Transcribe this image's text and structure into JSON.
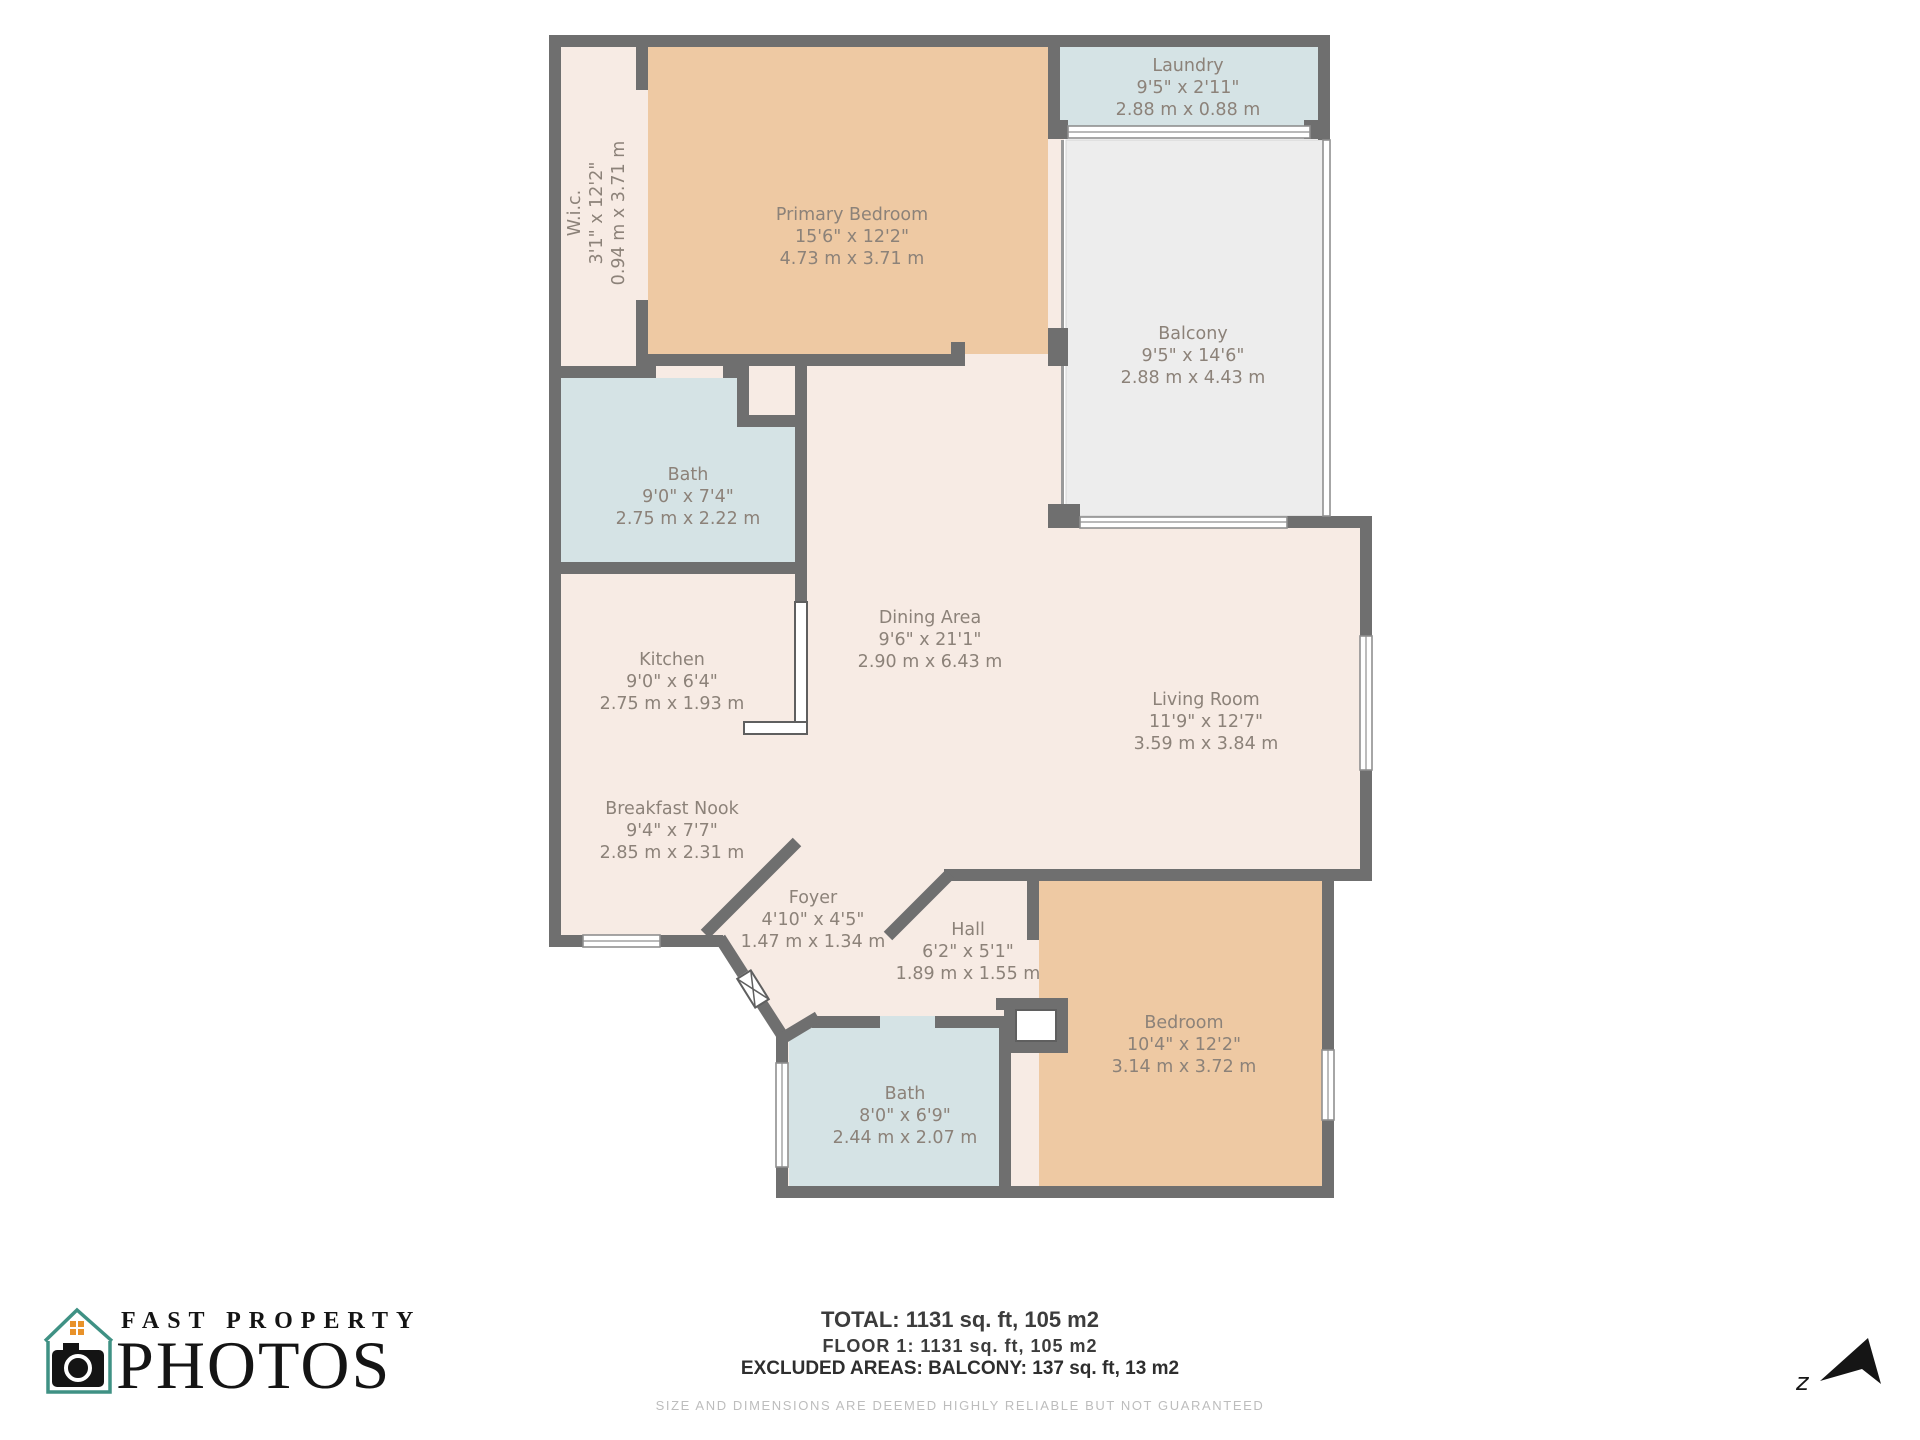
{
  "rooms": [
    {
      "id": "wic",
      "name": "W.i.c.",
      "dim_imperial": "3'1\" x 12'2\"",
      "dim_metric": "0.94 m x 3.71 m"
    },
    {
      "id": "primary_bedroom",
      "name": "Primary Bedroom",
      "dim_imperial": "15'6\" x 12'2\"",
      "dim_metric": "4.73 m x 3.71 m"
    },
    {
      "id": "laundry",
      "name": "Laundry",
      "dim_imperial": "9'5\" x 2'11\"",
      "dim_metric": "2.88 m x 0.88 m"
    },
    {
      "id": "balcony",
      "name": "Balcony",
      "dim_imperial": "9'5\" x 14'6\"",
      "dim_metric": "2.88 m x 4.43 m"
    },
    {
      "id": "bath_1",
      "name": "Bath",
      "dim_imperial": "9'0\" x 7'4\"",
      "dim_metric": "2.75 m x 2.22 m"
    },
    {
      "id": "kitchen",
      "name": "Kitchen",
      "dim_imperial": "9'0\" x 6'4\"",
      "dim_metric": "2.75 m x 1.93 m"
    },
    {
      "id": "dining_area",
      "name": "Dining Area",
      "dim_imperial": "9'6\" x 21'1\"",
      "dim_metric": "2.90 m x 6.43 m"
    },
    {
      "id": "living_room",
      "name": "Living Room",
      "dim_imperial": "11'9\" x 12'7\"",
      "dim_metric": "3.59 m x 3.84 m"
    },
    {
      "id": "breakfast_nook",
      "name": "Breakfast Nook",
      "dim_imperial": "9'4\" x 7'7\"",
      "dim_metric": "2.85 m x 2.31 m"
    },
    {
      "id": "foyer",
      "name": "Foyer",
      "dim_imperial": "4'10\" x 4'5\"",
      "dim_metric": "1.47 m x 1.34 m"
    },
    {
      "id": "hall",
      "name": "Hall",
      "dim_imperial": "6'2\" x 5'1\"",
      "dim_metric": "1.89 m x 1.55 m"
    },
    {
      "id": "bath_2",
      "name": "Bath",
      "dim_imperial": "8'0\" x 6'9\"",
      "dim_metric": "2.44 m x 2.07 m"
    },
    {
      "id": "bedroom",
      "name": "Bedroom",
      "dim_imperial": "10'4\" x 12'2\"",
      "dim_metric": "3.14 m x 3.72 m"
    }
  ],
  "summary": {
    "total": "TOTAL: 1131 sq. ft, 105 m2",
    "floor": "FLOOR 1: 1131 sq. ft, 105 m2",
    "excluded": "EXCLUDED AREAS: BALCONY: 137 sq. ft, 13 m2",
    "disclaimer": "SIZE AND DIMENSIONS ARE DEEMED HIGHLY RELIABLE BUT NOT GUARANTEED"
  },
  "logo": {
    "line1": "FAST PROPERTY",
    "line2": "PHOTOS"
  },
  "compass": {
    "label": "z"
  },
  "colors": {
    "wall": "#6f6f6f",
    "floor_cream": "#f7ebe4",
    "room_tan": "#eec9a3",
    "room_blue": "#d5e3e5",
    "balcony_gray": "#ededed",
    "label_text": "#8c8279",
    "logo_teal": "#3f9184",
    "logo_orange": "#e8922a",
    "logo_black": "#141414"
  }
}
